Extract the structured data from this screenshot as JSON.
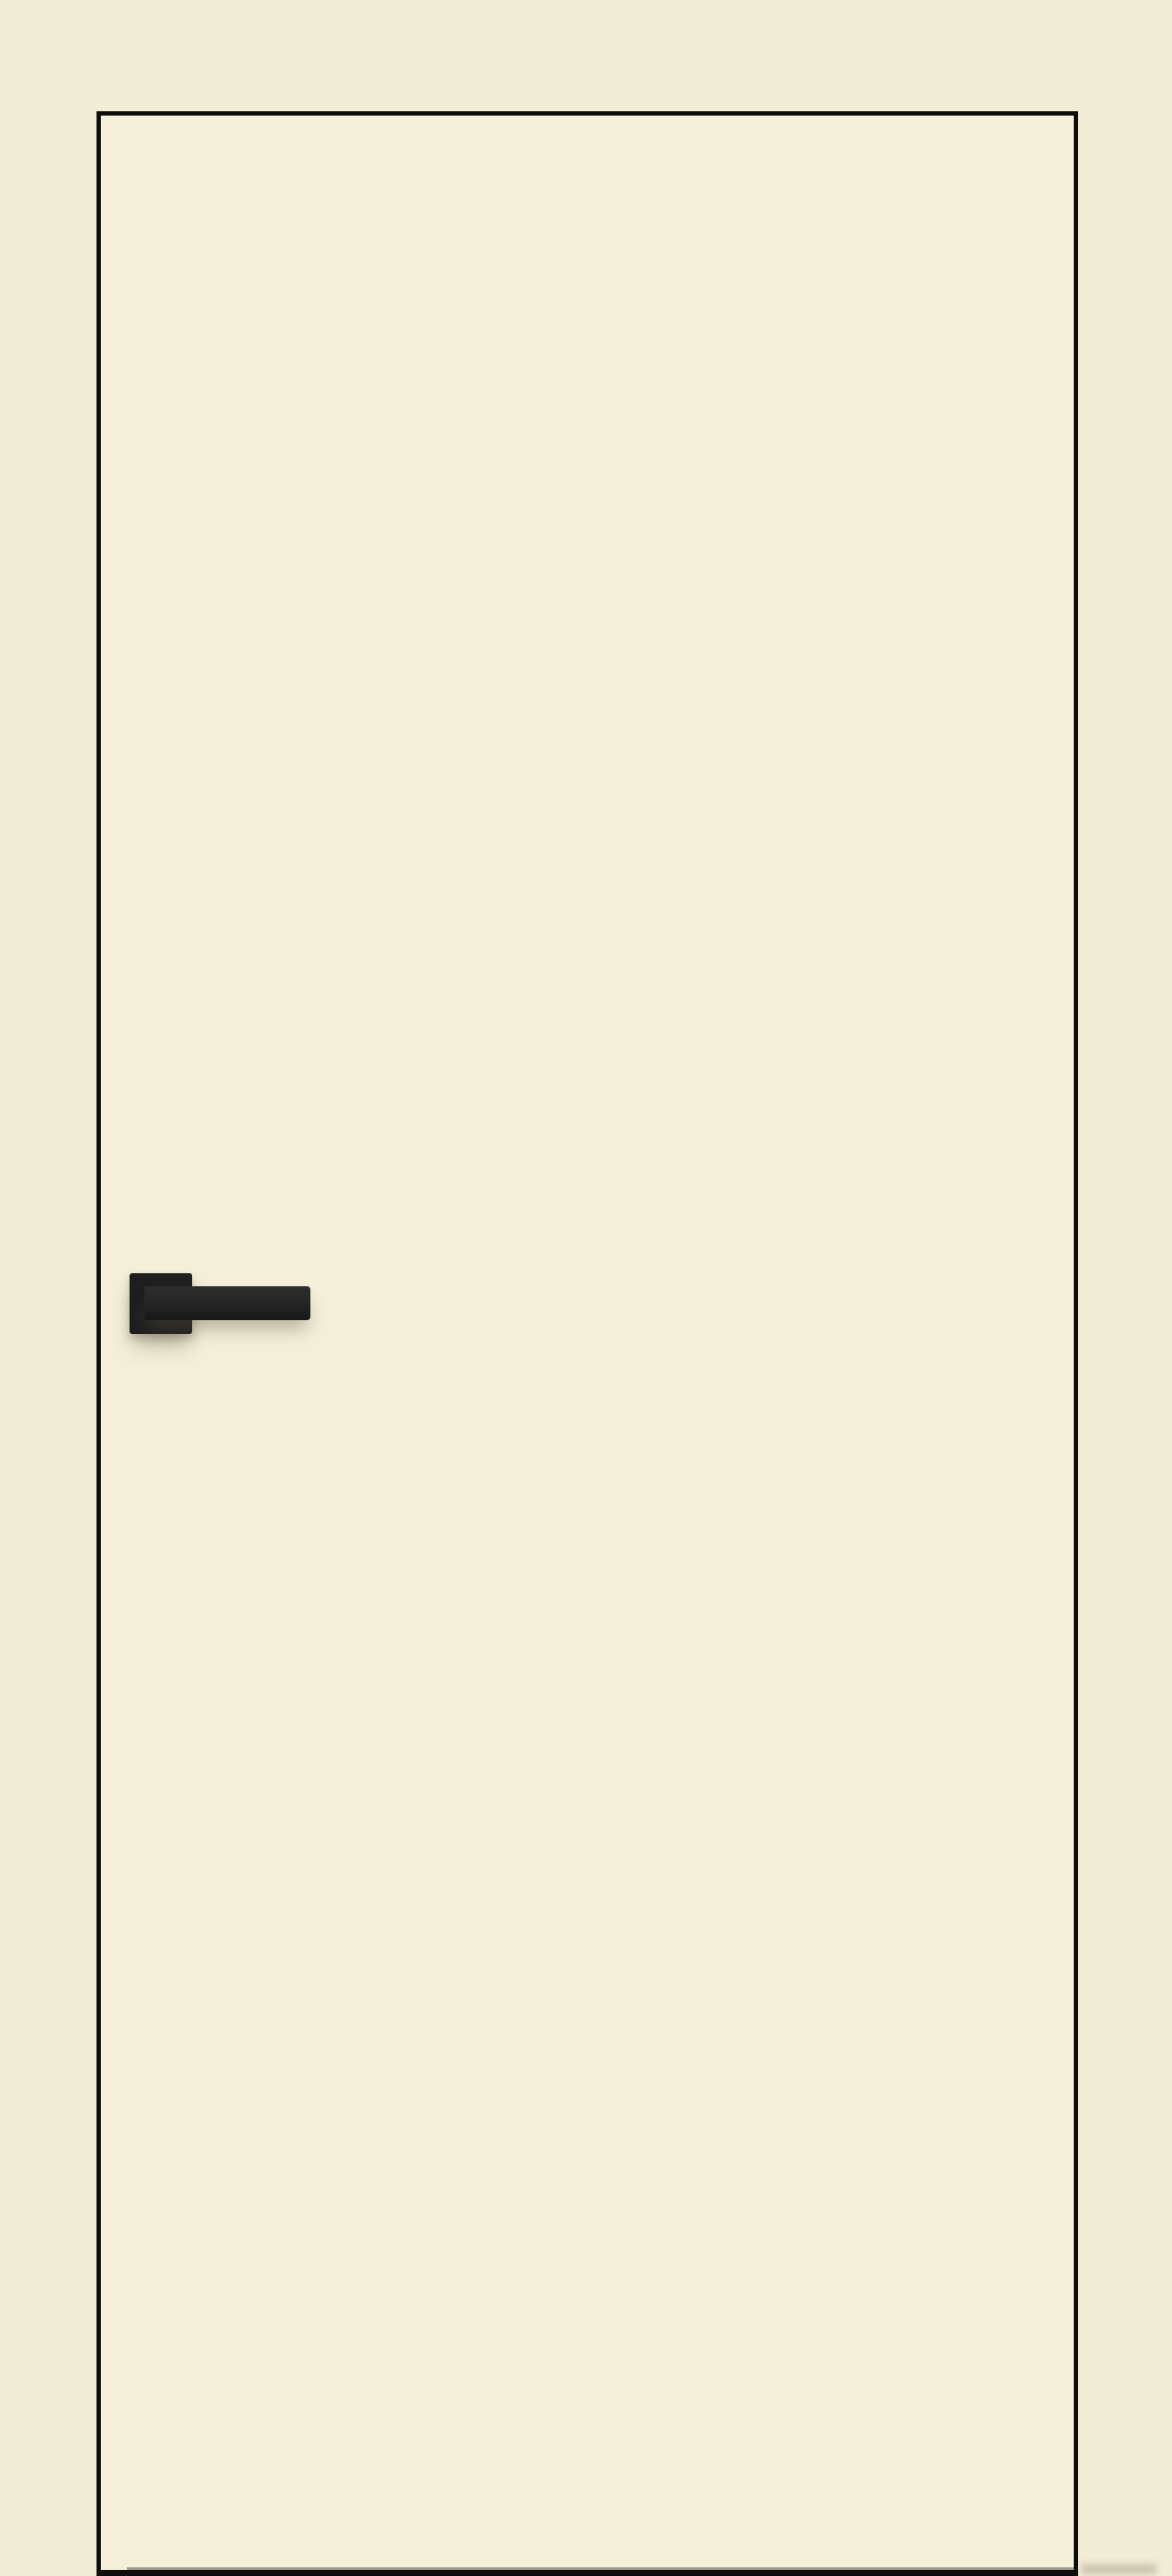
{
  "scene": {
    "subject": "flush interior door with black lever handle",
    "door_label": "cream flush door panel with black edge trim",
    "handle_label": "matte black square-rose lever door handle",
    "rose_label": "square handle rose plate",
    "lever_label": "rectangular lever bar"
  },
  "colors": {
    "background": "#f2edd5",
    "door-face": "#f3efd9",
    "door-trim": "#0f0e0c",
    "handle": "#1e1e1e",
    "lever-top": "#2e2e2e",
    "lever-mid": "#242424",
    "lever-bottom": "#181818",
    "gap-line": "#8d8b80",
    "shadow": "rgba(93,89,66,0.40)"
  }
}
